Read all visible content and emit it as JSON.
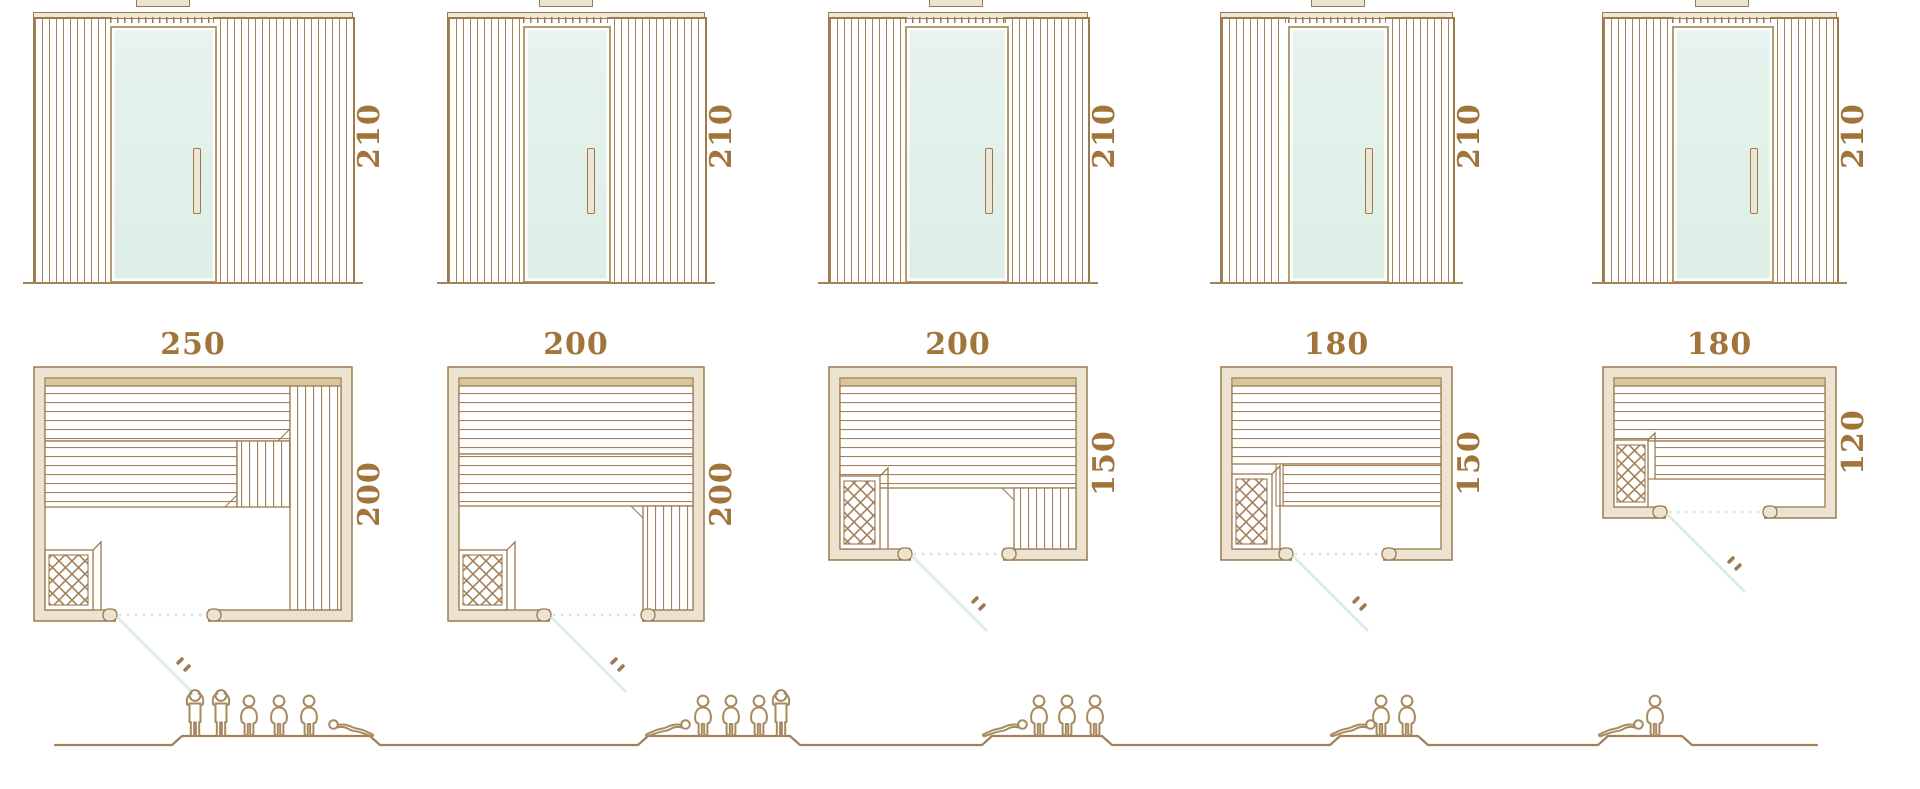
{
  "page": {
    "background": "#ffffff",
    "description": "Sauna cabin size range: front elevations (height in cm), floor plans (width x depth in cm) and seating capacity figures"
  },
  "units": [
    {
      "id": "unit-1",
      "elevation": {
        "height": "210"
      },
      "plan": {
        "width": "250",
        "depth": "200"
      },
      "capacity": {
        "standing": 2,
        "seated": 3,
        "lying": 1
      }
    },
    {
      "id": "unit-2",
      "elevation": {
        "height": "210"
      },
      "plan": {
        "width": "200",
        "depth": "200"
      },
      "capacity": {
        "standing": 1,
        "seated": 3,
        "lying": 1
      }
    },
    {
      "id": "unit-3",
      "elevation": {
        "height": "210"
      },
      "plan": {
        "width": "200",
        "depth": "150"
      },
      "capacity": {
        "standing": 0,
        "seated": 3,
        "lying": 1
      }
    },
    {
      "id": "unit-4",
      "elevation": {
        "height": "210"
      },
      "plan": {
        "width": "180",
        "depth": "150"
      },
      "capacity": {
        "standing": 0,
        "seated": 2,
        "lying": 1
      }
    },
    {
      "id": "unit-5",
      "elevation": {
        "height": "210"
      },
      "plan": {
        "width": "180",
        "depth": "120"
      },
      "capacity": {
        "standing": 0,
        "seated": 1,
        "lying": 1
      }
    }
  ],
  "colors": {
    "outline": "#9c7a50",
    "wood_line": "#a3825b",
    "wall_fill": "#ece4d0",
    "band_fill": "#d9c49c",
    "glass_fill": "#e2f0ea",
    "glass_frame": "#b89a6c",
    "door_swing": "#dceee5",
    "door_dotted": "#cfe8dd",
    "dimension_text": "#a1753a",
    "figure_outline": "#a68a5e"
  }
}
